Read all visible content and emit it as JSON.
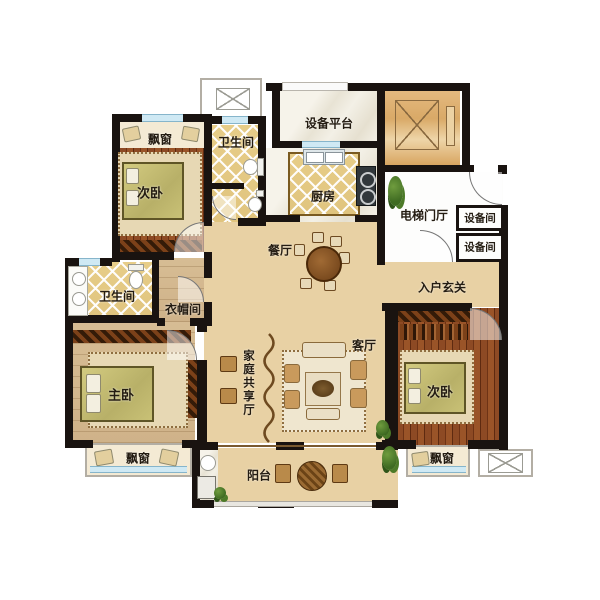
{
  "rooms": {
    "bay_tl": "飘窗",
    "bed_tl": "次卧",
    "bath_top": "卫生间",
    "equip_platform": "设备平台",
    "kitchen": "厨房",
    "elevator_hall": "电梯门厅",
    "equip_room_1": "设备间",
    "equip_room_2": "设备间",
    "dining": "餐厅",
    "foyer": "入户玄关",
    "bath_left": "卫生间",
    "cloakroom": "衣帽间",
    "master": "主卧",
    "family_hall": "家庭共享厅",
    "living": "客厅",
    "bed_right": "次卧",
    "bay_bl": "飘窗",
    "bay_br": "飘窗",
    "balcony": "阳台"
  },
  "colors": {
    "wall": "#191310",
    "floor_tile": "#e8d1a4",
    "bedroom_wood": "#8d4a24",
    "master_wood": "#d7bd94",
    "bath_tile": "#e7cd88",
    "window_glass": "#cfe9f4",
    "elevator_fill": "#d9a967",
    "bay_cream": "#f4ead4",
    "label_text": "#241c12"
  }
}
